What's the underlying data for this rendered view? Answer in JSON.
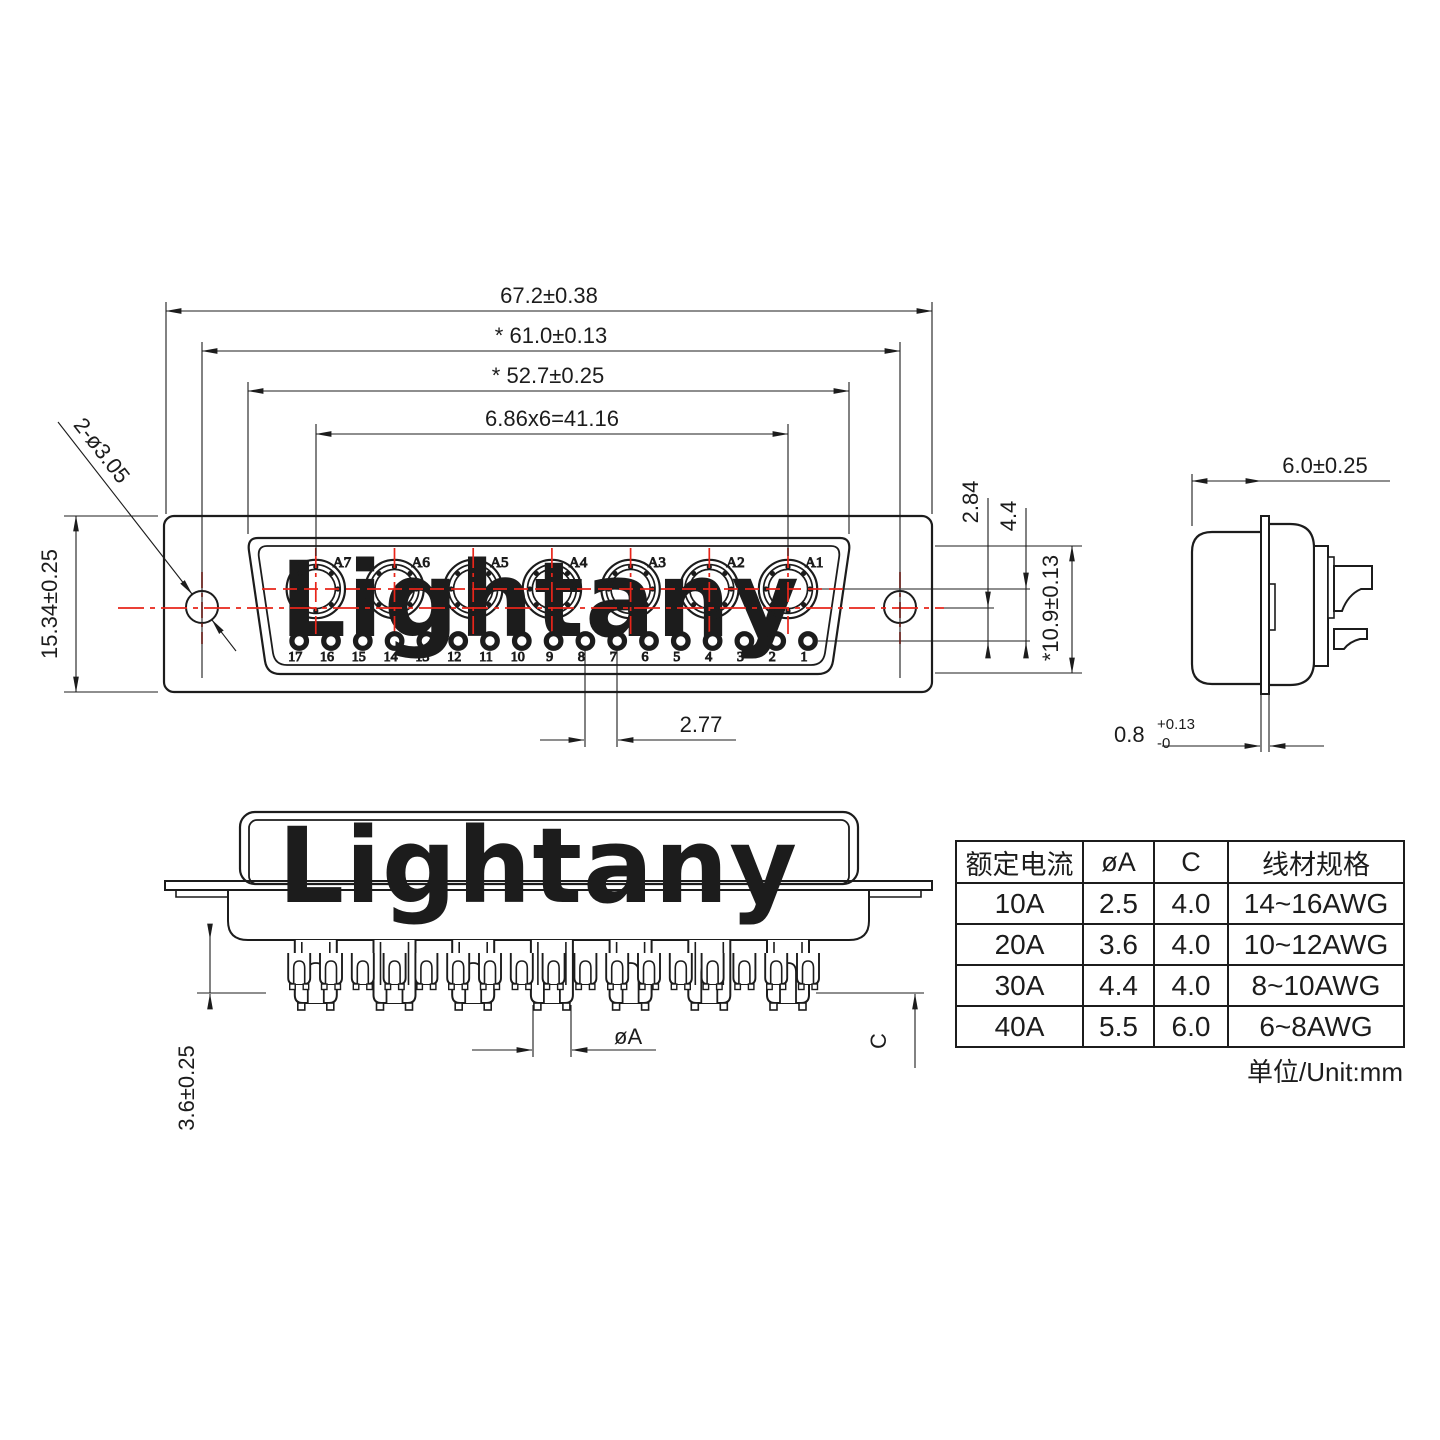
{
  "watermark": {
    "text": "Lightany",
    "color": "#f8d5d0"
  },
  "colors": {
    "line": "#1c1c1c",
    "red": "#e8251a"
  },
  "front_view": {
    "contact_labels": [
      "A1",
      "A2",
      "A3",
      "A4",
      "A5",
      "A6",
      "A7"
    ],
    "pin_labels": [
      "1",
      "2",
      "3",
      "4",
      "5",
      "6",
      "7",
      "8",
      "9",
      "10",
      "11",
      "12",
      "13",
      "14",
      "15",
      "16",
      "17"
    ],
    "dims": {
      "total_width": "67.2±0.38",
      "hole_span": "* 61.0±0.13",
      "shroud_width": "* 52.7±0.25",
      "contact_pitch": "6.86x6=41.16",
      "flange_height": "15.34±0.25",
      "mount_holes": "2-ø3.05",
      "row_offset": "2.84",
      "row_gap": "4.4",
      "opening_height": "*10.9±0.13",
      "pin_pitch": "2.77"
    }
  },
  "side_view": {
    "dims": {
      "shell_depth": "6.0±0.25",
      "flange_thickness_base": "0.8",
      "flange_thickness_sup": "+0.13",
      "flange_thickness_sub": "-0"
    }
  },
  "bottom_view": {
    "dims": {
      "tail_length": "3.6±0.25",
      "cup_diameter": "øA",
      "cup_depth": "C"
    }
  },
  "table": {
    "headers": [
      "额定电流",
      "øA",
      "C",
      "线材规格"
    ],
    "rows": [
      [
        "10A",
        "2.5",
        "4.0",
        "14~16AWG"
      ],
      [
        "20A",
        "3.6",
        "4.0",
        "10~12AWG"
      ],
      [
        "30A",
        "4.4",
        "4.0",
        "8~10AWG"
      ],
      [
        "40A",
        "5.5",
        "6.0",
        "6~8AWG"
      ]
    ],
    "unit_note": "单位/Unit:mm"
  }
}
